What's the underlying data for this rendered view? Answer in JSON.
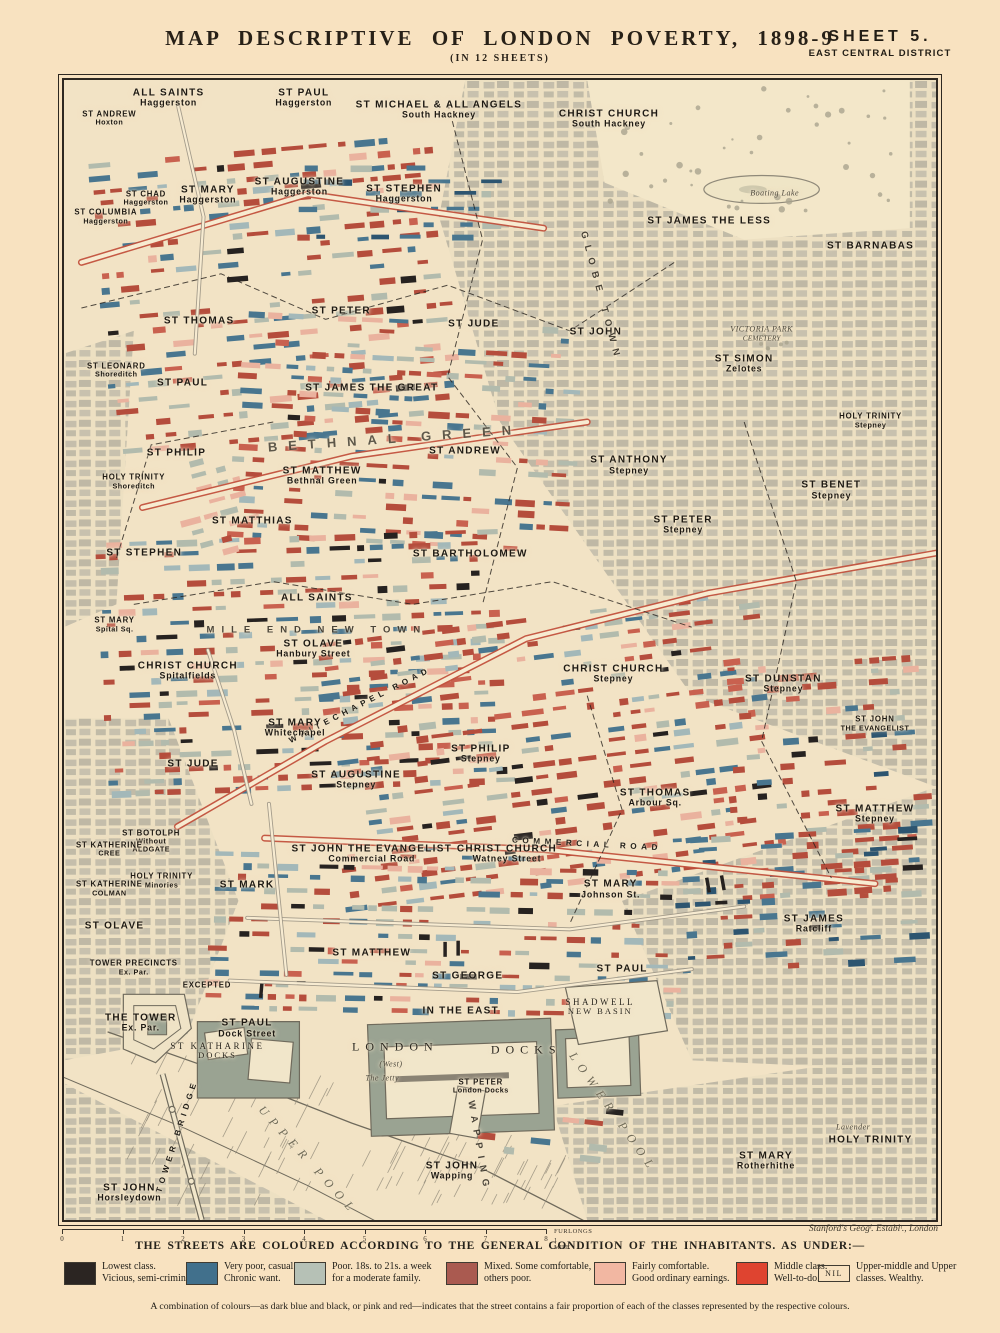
{
  "header": {
    "title": "MAP DESCRIPTIVE OF LONDON POVERTY, 1898-9",
    "subtitle": "(IN 12 SHEETS)",
    "sheet": "SHEET 5.",
    "district": "EAST CENTRAL DISTRICT"
  },
  "palette": {
    "street_red": "#b54d3c",
    "street_red2": "#c9614f",
    "street_pink": "#eab29e",
    "street_blue": "#49768f",
    "street_darkblue": "#2d5570",
    "street_black": "#262220",
    "street_grey": "#b2bbad",
    "street_lightblue": "#a3b8b9",
    "paper": "#f2e3c5",
    "engraving_grey": "#8d8676",
    "dock_grey": "#9aa392"
  },
  "map": {
    "credit": "Stanford's Geogˡ. Establᵗ., London",
    "scale": {
      "ticks": [
        "0",
        "1",
        "2",
        "3",
        "4",
        "5",
        "6",
        "7",
        "8"
      ],
      "unit": "FURLONGS",
      "mile": "1 MILE"
    },
    "labels": [
      {
        "lines": [
          "ALL SAINTS",
          "Haggerston"
        ],
        "x": 12,
        "y": 1.6,
        "style": "parish"
      },
      {
        "lines": [
          "ST PAUL",
          "Haggerston"
        ],
        "x": 27.5,
        "y": 1.6,
        "style": "parish"
      },
      {
        "lines": [
          "ST MICHAEL & ALL ANGELS",
          "South Hackney"
        ],
        "x": 43,
        "y": 2.6,
        "style": "parish"
      },
      {
        "lines": [
          "CHRIST CHURCH",
          "South Hackney"
        ],
        "x": 62.5,
        "y": 3.4,
        "style": "parish"
      },
      {
        "lines": [
          "ST ANDREW",
          "Hoxton"
        ],
        "x": 5.2,
        "y": 3.4,
        "style": "parish-sm"
      },
      {
        "lines": [
          "ST CHAD",
          "Haggerston"
        ],
        "x": 9.4,
        "y": 10.4,
        "style": "parish-sm"
      },
      {
        "lines": [
          "ST MARY",
          "Haggerston"
        ],
        "x": 16.5,
        "y": 10.1,
        "style": "parish"
      },
      {
        "lines": [
          "ST AUGUSTINE",
          "Haggerston"
        ],
        "x": 27,
        "y": 9.4,
        "style": "parish"
      },
      {
        "lines": [
          "ST STEPHEN",
          "Haggerston"
        ],
        "x": 39,
        "y": 10,
        "style": "parish"
      },
      {
        "lines": [
          "ST COLUMBIA",
          "Haggerston"
        ],
        "x": 4.8,
        "y": 12,
        "style": "parish-sm"
      },
      {
        "lines": [
          "ST JAMES THE LESS"
        ],
        "x": 74,
        "y": 12.4,
        "style": "parish"
      },
      {
        "lines": [
          "Boating Lake"
        ],
        "x": 81.5,
        "y": 10,
        "style": "tiny"
      },
      {
        "lines": [
          "ST BARNABAS"
        ],
        "x": 92.5,
        "y": 14.6,
        "style": "parish"
      },
      {
        "lines": [
          "ST THOMAS"
        ],
        "x": 15.5,
        "y": 21.1,
        "style": "parish"
      },
      {
        "lines": [
          "ST PETER"
        ],
        "x": 31.8,
        "y": 20.3,
        "style": "parish"
      },
      {
        "lines": [
          "ST JUDE"
        ],
        "x": 47,
        "y": 21.4,
        "style": "parish"
      },
      {
        "lines": [
          "ST JOHN"
        ],
        "x": 61,
        "y": 22.1,
        "style": "parish"
      },
      {
        "lines": [
          "GLOBE TOWN"
        ],
        "x": 61.5,
        "y": 19,
        "style": "district-sm",
        "rot": 75
      },
      {
        "lines": [
          "ST LEONARD",
          "Shoreditch"
        ],
        "x": 6,
        "y": 25.5,
        "style": "parish-sm"
      },
      {
        "lines": [
          "ST PAUL"
        ],
        "x": 13.6,
        "y": 26.6,
        "style": "parish"
      },
      {
        "lines": [
          "ST JAMES THE GREAT"
        ],
        "x": 35.3,
        "y": 27,
        "style": "parish"
      },
      {
        "lines": [
          "ST SIMON",
          "Zelotes"
        ],
        "x": 78,
        "y": 24.9,
        "style": "parish"
      },
      {
        "lines": [
          "VICTORIA PARK",
          "CEMETERY"
        ],
        "x": 80,
        "y": 22.3,
        "style": "tiny"
      },
      {
        "lines": [
          "BETHNAL GREEN"
        ],
        "x": 38,
        "y": 31.5,
        "style": "district",
        "rot": -4
      },
      {
        "lines": [
          "ST PHILIP"
        ],
        "x": 12.9,
        "y": 32.7,
        "style": "parish"
      },
      {
        "lines": [
          "ST ANDREW"
        ],
        "x": 46,
        "y": 32.5,
        "style": "parish"
      },
      {
        "lines": [
          "ST MATTHEW",
          "Bethnal Green"
        ],
        "x": 29.6,
        "y": 34.7,
        "style": "parish"
      },
      {
        "lines": [
          "HOLY TRINITY",
          "Shoreditch"
        ],
        "x": 8,
        "y": 35.3,
        "style": "parish-sm"
      },
      {
        "lines": [
          "HOLY TRINITY",
          "Stepney"
        ],
        "x": 92.5,
        "y": 29.9,
        "style": "parish-sm"
      },
      {
        "lines": [
          "ST ANTHONY",
          "Stepney"
        ],
        "x": 64.8,
        "y": 33.8,
        "style": "parish"
      },
      {
        "lines": [
          "ST BENET",
          "Stepney"
        ],
        "x": 88,
        "y": 36,
        "style": "parish"
      },
      {
        "lines": [
          "ST PETER",
          "Stepney"
        ],
        "x": 71,
        "y": 39,
        "style": "parish"
      },
      {
        "lines": [
          "ST MATTHIAS"
        ],
        "x": 21.6,
        "y": 38.7,
        "style": "parish"
      },
      {
        "lines": [
          "ST STEPHEN"
        ],
        "x": 9.2,
        "y": 41.5,
        "style": "parish"
      },
      {
        "lines": [
          "ST BARTHOLOMEW"
        ],
        "x": 46.6,
        "y": 41.6,
        "style": "parish"
      },
      {
        "lines": [
          "ALL SAINTS"
        ],
        "x": 29,
        "y": 45.4,
        "style": "parish"
      },
      {
        "lines": [
          "ST MARY",
          "Spital Sq."
        ],
        "x": 5.8,
        "y": 47.8,
        "style": "parish-sm"
      },
      {
        "lines": [
          "MILE END NEW TOWN"
        ],
        "x": 29,
        "y": 48.3,
        "style": "district-sm"
      },
      {
        "lines": [
          "ST OLAVE",
          "Hanbury Street"
        ],
        "x": 28.6,
        "y": 49.9,
        "style": "parish"
      },
      {
        "lines": [
          "CHRIST CHURCH",
          "Spitalfields"
        ],
        "x": 14.2,
        "y": 51.8,
        "style": "parish"
      },
      {
        "lines": [
          "WHITECHAPEL ROAD"
        ],
        "x": 34,
        "y": 54.8,
        "style": "road",
        "rot": -27
      },
      {
        "lines": [
          "CHRIST CHURCH",
          "Stepney"
        ],
        "x": 63,
        "y": 52.1,
        "style": "parish"
      },
      {
        "lines": [
          "ST DUNSTAN",
          "Stepney"
        ],
        "x": 82.5,
        "y": 53,
        "style": "parish"
      },
      {
        "lines": [
          "ST JOHN",
          "THE EVANGELIST"
        ],
        "x": 93,
        "y": 56.5,
        "style": "parish-sm"
      },
      {
        "lines": [
          "ST MARY",
          "Whitechapel"
        ],
        "x": 26.5,
        "y": 56.8,
        "style": "parish"
      },
      {
        "lines": [
          "ST JUDE"
        ],
        "x": 14.8,
        "y": 60,
        "style": "parish"
      },
      {
        "lines": [
          "ST PHILIP",
          "Stepney"
        ],
        "x": 47.8,
        "y": 59.1,
        "style": "parish"
      },
      {
        "lines": [
          "ST AUGUSTINE",
          "Stepney"
        ],
        "x": 33.5,
        "y": 61.4,
        "style": "parish"
      },
      {
        "lines": [
          "ST THOMAS",
          "Arbour Sq."
        ],
        "x": 67.8,
        "y": 63,
        "style": "parish"
      },
      {
        "lines": [
          "ST MATTHEW",
          "Stepney"
        ],
        "x": 93,
        "y": 64.4,
        "style": "parish"
      },
      {
        "lines": [
          "COMMERCIAL ROAD"
        ],
        "x": 60,
        "y": 67,
        "style": "road",
        "rot": 3
      },
      {
        "lines": [
          "ST BOTOLPH",
          "Without",
          "ALDGATE"
        ],
        "x": 10,
        "y": 66.8,
        "style": "parish-sm"
      },
      {
        "lines": [
          "ST KATHERINE",
          "CREE"
        ],
        "x": 5.2,
        "y": 67.5,
        "style": "parish-sm"
      },
      {
        "lines": [
          "ST JOHN THE EVANGELIST",
          "Commercial Road"
        ],
        "x": 35.3,
        "y": 67.9,
        "style": "parish"
      },
      {
        "lines": [
          "CHRIST CHURCH",
          "Watney Street"
        ],
        "x": 50.8,
        "y": 67.9,
        "style": "parish"
      },
      {
        "lines": [
          "HOLY TRINITY",
          "Minories"
        ],
        "x": 11.2,
        "y": 70.3,
        "style": "parish-sm"
      },
      {
        "lines": [
          "ST KATHERINE",
          "COLMAN"
        ],
        "x": 5.2,
        "y": 71,
        "style": "parish-sm"
      },
      {
        "lines": [
          "ST MARK"
        ],
        "x": 21,
        "y": 70.6,
        "style": "parish"
      },
      {
        "lines": [
          "ST MARY",
          "Johnson St."
        ],
        "x": 62.7,
        "y": 71,
        "style": "parish"
      },
      {
        "lines": [
          "ST OLAVE"
        ],
        "x": 5.8,
        "y": 74.2,
        "style": "parish"
      },
      {
        "lines": [
          "ST JAMES",
          "Ratcliff"
        ],
        "x": 86,
        "y": 74,
        "style": "parish"
      },
      {
        "lines": [
          "TOWER PRECINCTS",
          "Ex. Par."
        ],
        "x": 8,
        "y": 77.9,
        "style": "parish-sm"
      },
      {
        "lines": [
          "EXCEPTED"
        ],
        "x": 16.4,
        "y": 79.5,
        "style": "parish-sm"
      },
      {
        "lines": [
          "ST MATTHEW"
        ],
        "x": 35.3,
        "y": 76.6,
        "style": "parish"
      },
      {
        "lines": [
          "ST GEORGE"
        ],
        "x": 46.3,
        "y": 78.6,
        "style": "parish"
      },
      {
        "lines": [
          "IN THE EAST"
        ],
        "x": 45.5,
        "y": 81.7,
        "style": "parish"
      },
      {
        "lines": [
          "ST PAUL"
        ],
        "x": 64,
        "y": 78,
        "style": "parish"
      },
      {
        "lines": [
          "SHADWELL",
          "NEW BASIN"
        ],
        "x": 61.5,
        "y": 81.3,
        "style": "dock-sm"
      },
      {
        "lines": [
          "THE TOWER",
          "Ex. Par."
        ],
        "x": 8.8,
        "y": 82.7,
        "style": "parish"
      },
      {
        "lines": [
          "ST PAUL",
          "Dock Street"
        ],
        "x": 21,
        "y": 83.2,
        "style": "parish"
      },
      {
        "lines": [
          "ST KATHARINE",
          "DOCKS"
        ],
        "x": 17.6,
        "y": 85.2,
        "style": "dock-sm"
      },
      {
        "lines": [
          "LONDON"
        ],
        "x": 38,
        "y": 84.8,
        "style": "dock"
      },
      {
        "lines": [
          "DOCKS"
        ],
        "x": 53,
        "y": 85.1,
        "style": "dock"
      },
      {
        "lines": [
          "(West)"
        ],
        "x": 37.5,
        "y": 86.4,
        "style": "tiny"
      },
      {
        "lines": [
          "The Jetty"
        ],
        "x": 36.5,
        "y": 87.6,
        "style": "tiny"
      },
      {
        "lines": [
          "ST PETER",
          "London Docks"
        ],
        "x": 47.8,
        "y": 88.3,
        "style": "parish-sm"
      },
      {
        "lines": [
          "TOWER BRIDGE"
        ],
        "x": 13,
        "y": 92.6,
        "style": "road",
        "rot": -72
      },
      {
        "lines": [
          "WAPPING"
        ],
        "x": 47.5,
        "y": 93.6,
        "style": "district-sm",
        "rot": 80
      },
      {
        "lines": [
          "UPPER POOL"
        ],
        "x": 28,
        "y": 94.8,
        "style": "water",
        "rot": 48
      },
      {
        "lines": [
          "LOWER POOL"
        ],
        "x": 63,
        "y": 90.6,
        "style": "water",
        "rot": 55
      },
      {
        "lines": [
          "ST JOHN",
          "Wapping"
        ],
        "x": 44.5,
        "y": 95.7,
        "style": "parish"
      },
      {
        "lines": [
          "ST JOHN",
          "Horsleydown"
        ],
        "x": 7.5,
        "y": 97.6,
        "style": "parish"
      },
      {
        "lines": [
          "ST MARY",
          "Rotherhithe"
        ],
        "x": 80.5,
        "y": 94.8,
        "style": "parish"
      },
      {
        "lines": [
          "Lavender"
        ],
        "x": 90.5,
        "y": 91.9,
        "style": "tiny"
      },
      {
        "lines": [
          "HOLY TRINITY"
        ],
        "x": 92.5,
        "y": 93,
        "style": "parish"
      }
    ]
  },
  "legend": {
    "heading": "THE STREETS ARE COLOURED ACCORDING TO THE GENERAL CONDITION OF THE INHABITANTS. AS UNDER:—",
    "items": [
      {
        "swatch": "#2b2522",
        "nil": false,
        "lines": [
          "Lowest class.",
          "Vicious, semi-criminal."
        ]
      },
      {
        "swatch": "#41708c",
        "nil": false,
        "lines": [
          "Very poor, casual.",
          "Chronic want."
        ]
      },
      {
        "swatch": "#b6c1b6",
        "nil": false,
        "lines": [
          "Poor.  18s. to 21s. a week",
          "for a moderate family."
        ]
      },
      {
        "swatch": "#aa5a50",
        "nil": false,
        "lines": [
          "Mixed.  Some comfortable,",
          "others poor."
        ]
      },
      {
        "swatch": "#f2b7a2",
        "nil": false,
        "lines": [
          "Fairly comfortable.",
          "Good ordinary earnings."
        ]
      },
      {
        "swatch": "#df4430",
        "nil": false,
        "lines": [
          "Middle class.",
          "Well-to-do."
        ]
      },
      {
        "swatch": null,
        "nil": true,
        "nil_label": "NIL",
        "lines": [
          "Upper-middle and Upper",
          "classes.  Wealthy."
        ]
      }
    ],
    "note": "A combination of colours—as dark blue and black, or pink and red—indicates that the street contains a fair proportion of each of the classes represented by the respective colours."
  }
}
